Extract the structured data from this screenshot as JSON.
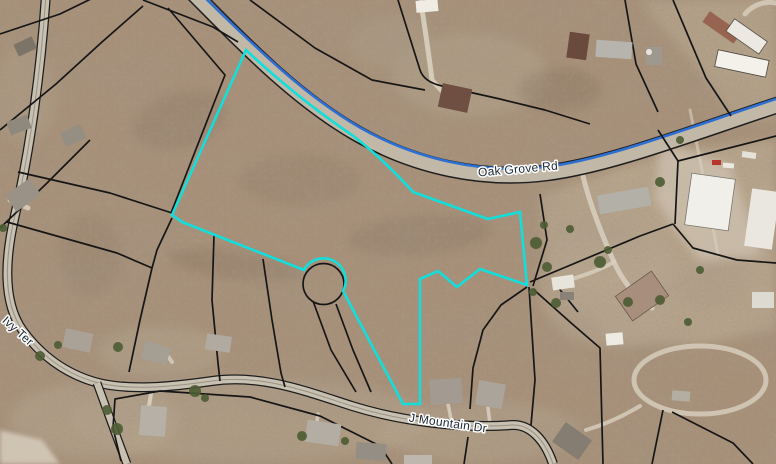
{
  "map": {
    "type": "aerial-parcel-map",
    "labels": {
      "road_main": "Oak Grove Rd",
      "road_south": "J Mountain Dr",
      "road_west": "Ivy Ter"
    },
    "colors": {
      "parcel_highlight": "#12DEDB",
      "road_centerline_blue": "#2E6FD2",
      "parcel_line": "#161616",
      "label_text": "#1C2733",
      "label_halo": "#FFFFFF"
    }
  }
}
